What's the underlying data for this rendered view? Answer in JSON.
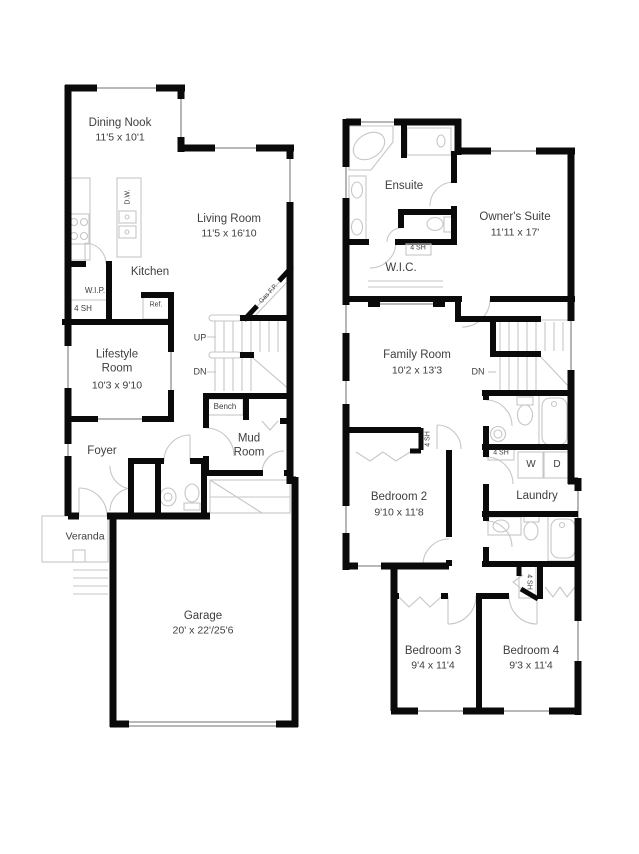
{
  "colors": {
    "wall": "#0a0a0a",
    "line": "#c6c6c6",
    "win": "#aeaeae",
    "text": "#3e3e3e",
    "bg": "#ffffff"
  },
  "first_floor": {
    "dining_nook": {
      "name": "Dining Nook",
      "dims": "11'5 x 10'1"
    },
    "living_room": {
      "name": "Living Room",
      "dims": "11'5 x 16'10"
    },
    "kitchen": {
      "name": "Kitchen"
    },
    "wip": {
      "name": "W.I.P."
    },
    "pantry_shelf": {
      "label": "4 SH"
    },
    "fridge": {
      "label": "Ref."
    },
    "dishwasher": {
      "label": "D.W."
    },
    "lifestyle_room": {
      "name": "Lifestyle Room",
      "dims": "10'3 x 9'10"
    },
    "foyer": {
      "name": "Foyer"
    },
    "veranda": {
      "name": "Veranda"
    },
    "mud_room": {
      "name": "Mud Room"
    },
    "bench": {
      "label": "Bench"
    },
    "stairs": {
      "up": "UP",
      "down": "DN"
    },
    "fireplace": {
      "label": "Gas F.P."
    },
    "garage": {
      "name": "Garage",
      "dims": "20' x 22'/25'6"
    }
  },
  "second_floor": {
    "ensuite": {
      "name": "Ensuite"
    },
    "owners_suite": {
      "name": "Owner's Suite",
      "dims": "11'11 x 17'"
    },
    "wc_shelf": {
      "label": "4 SH"
    },
    "wic": {
      "name": "W.I.C."
    },
    "family_room": {
      "name": "Family Room",
      "dims": "10'2 x 13'3"
    },
    "stairs": {
      "down": "DN"
    },
    "bedroom2_shelf": {
      "label": "4 SH"
    },
    "bedroom2": {
      "name": "Bedroom 2",
      "dims": "9'10 x 11'8"
    },
    "laundry_shelf": {
      "label": "4 SH"
    },
    "washer": {
      "label": "W"
    },
    "dryer": {
      "label": "D"
    },
    "laundry": {
      "name": "Laundry"
    },
    "hall_shelf": {
      "label": "4 SH"
    },
    "bedroom3": {
      "name": "Bedroom 3",
      "dims": "9'4 x 11'4"
    },
    "bedroom4": {
      "name": "Bedroom 4",
      "dims": "9'3 x 11'4"
    }
  }
}
